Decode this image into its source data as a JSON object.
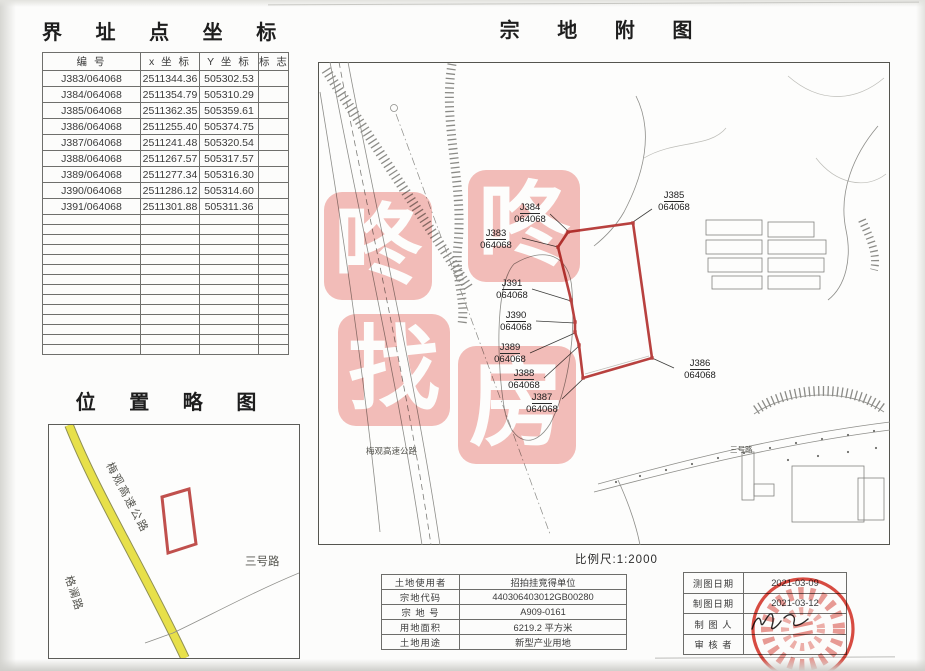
{
  "coords_panel": {
    "title": "界 址 点 坐 标",
    "headers": [
      "编 号",
      "x 坐 标",
      "Y 坐 标",
      "标 志"
    ],
    "rows": [
      [
        "J383/064068",
        "2511344.36",
        "505302.53",
        ""
      ],
      [
        "J384/064068",
        "2511354.79",
        "505310.29",
        ""
      ],
      [
        "J385/064068",
        "2511362.35",
        "505359.61",
        ""
      ],
      [
        "J386/064068",
        "2511255.40",
        "505374.75",
        ""
      ],
      [
        "J387/064068",
        "2511241.48",
        "505320.54",
        ""
      ],
      [
        "J388/064068",
        "2511267.57",
        "505317.57",
        ""
      ],
      [
        "J389/064068",
        "2511277.34",
        "505316.30",
        ""
      ],
      [
        "J390/064068",
        "2511286.12",
        "505314.60",
        ""
      ],
      [
        "J391/064068",
        "2511301.88",
        "505311.36",
        ""
      ]
    ]
  },
  "location_panel": {
    "title": "位 置 略 图",
    "roads": {
      "expressway": "梅观高速公路",
      "side_road": "格澜路",
      "road3": "三号路"
    }
  },
  "plat_panel": {
    "title": "宗 地 附 图",
    "scale_label": "比例尺:1:2000",
    "expressway_label": "梅观高速公路",
    "road3_label": "三号路",
    "points": [
      {
        "id": "J383",
        "code": "064068"
      },
      {
        "id": "J384",
        "code": "064068"
      },
      {
        "id": "J385",
        "code": "064068"
      },
      {
        "id": "J386",
        "code": "064068"
      },
      {
        "id": "J387",
        "code": "064068"
      },
      {
        "id": "J388",
        "code": "064068"
      },
      {
        "id": "J389",
        "code": "064068"
      },
      {
        "id": "J390",
        "code": "064068"
      },
      {
        "id": "J391",
        "code": "064068"
      }
    ]
  },
  "watermark": {
    "chars": [
      "咚",
      "咚",
      "找",
      "房"
    ]
  },
  "land_info": {
    "rows": [
      {
        "label": "土地使用者",
        "value": "招拍挂竞得单位"
      },
      {
        "label": "宗地代码",
        "value": "440306403012GB00280"
      },
      {
        "label": "宗 地 号",
        "value": "A909-0161"
      },
      {
        "label": "用地面积",
        "value": "6219.2 平方米"
      },
      {
        "label": "土地用途",
        "value": "新型产业用地"
      }
    ]
  },
  "meta_info": {
    "rows": [
      {
        "label": "测图日期",
        "value": "2021-03-09"
      },
      {
        "label": "制图日期",
        "value": "2021-03-12"
      },
      {
        "label": "制 图 人",
        "value": ""
      },
      {
        "label": "审 核 者",
        "value": ""
      }
    ]
  },
  "colors": {
    "parcel_red": "#b8413f",
    "watermark_pink": "#f3b9b4",
    "road_yellow": "#e7e04a",
    "stamp_red": "#d6392d"
  }
}
